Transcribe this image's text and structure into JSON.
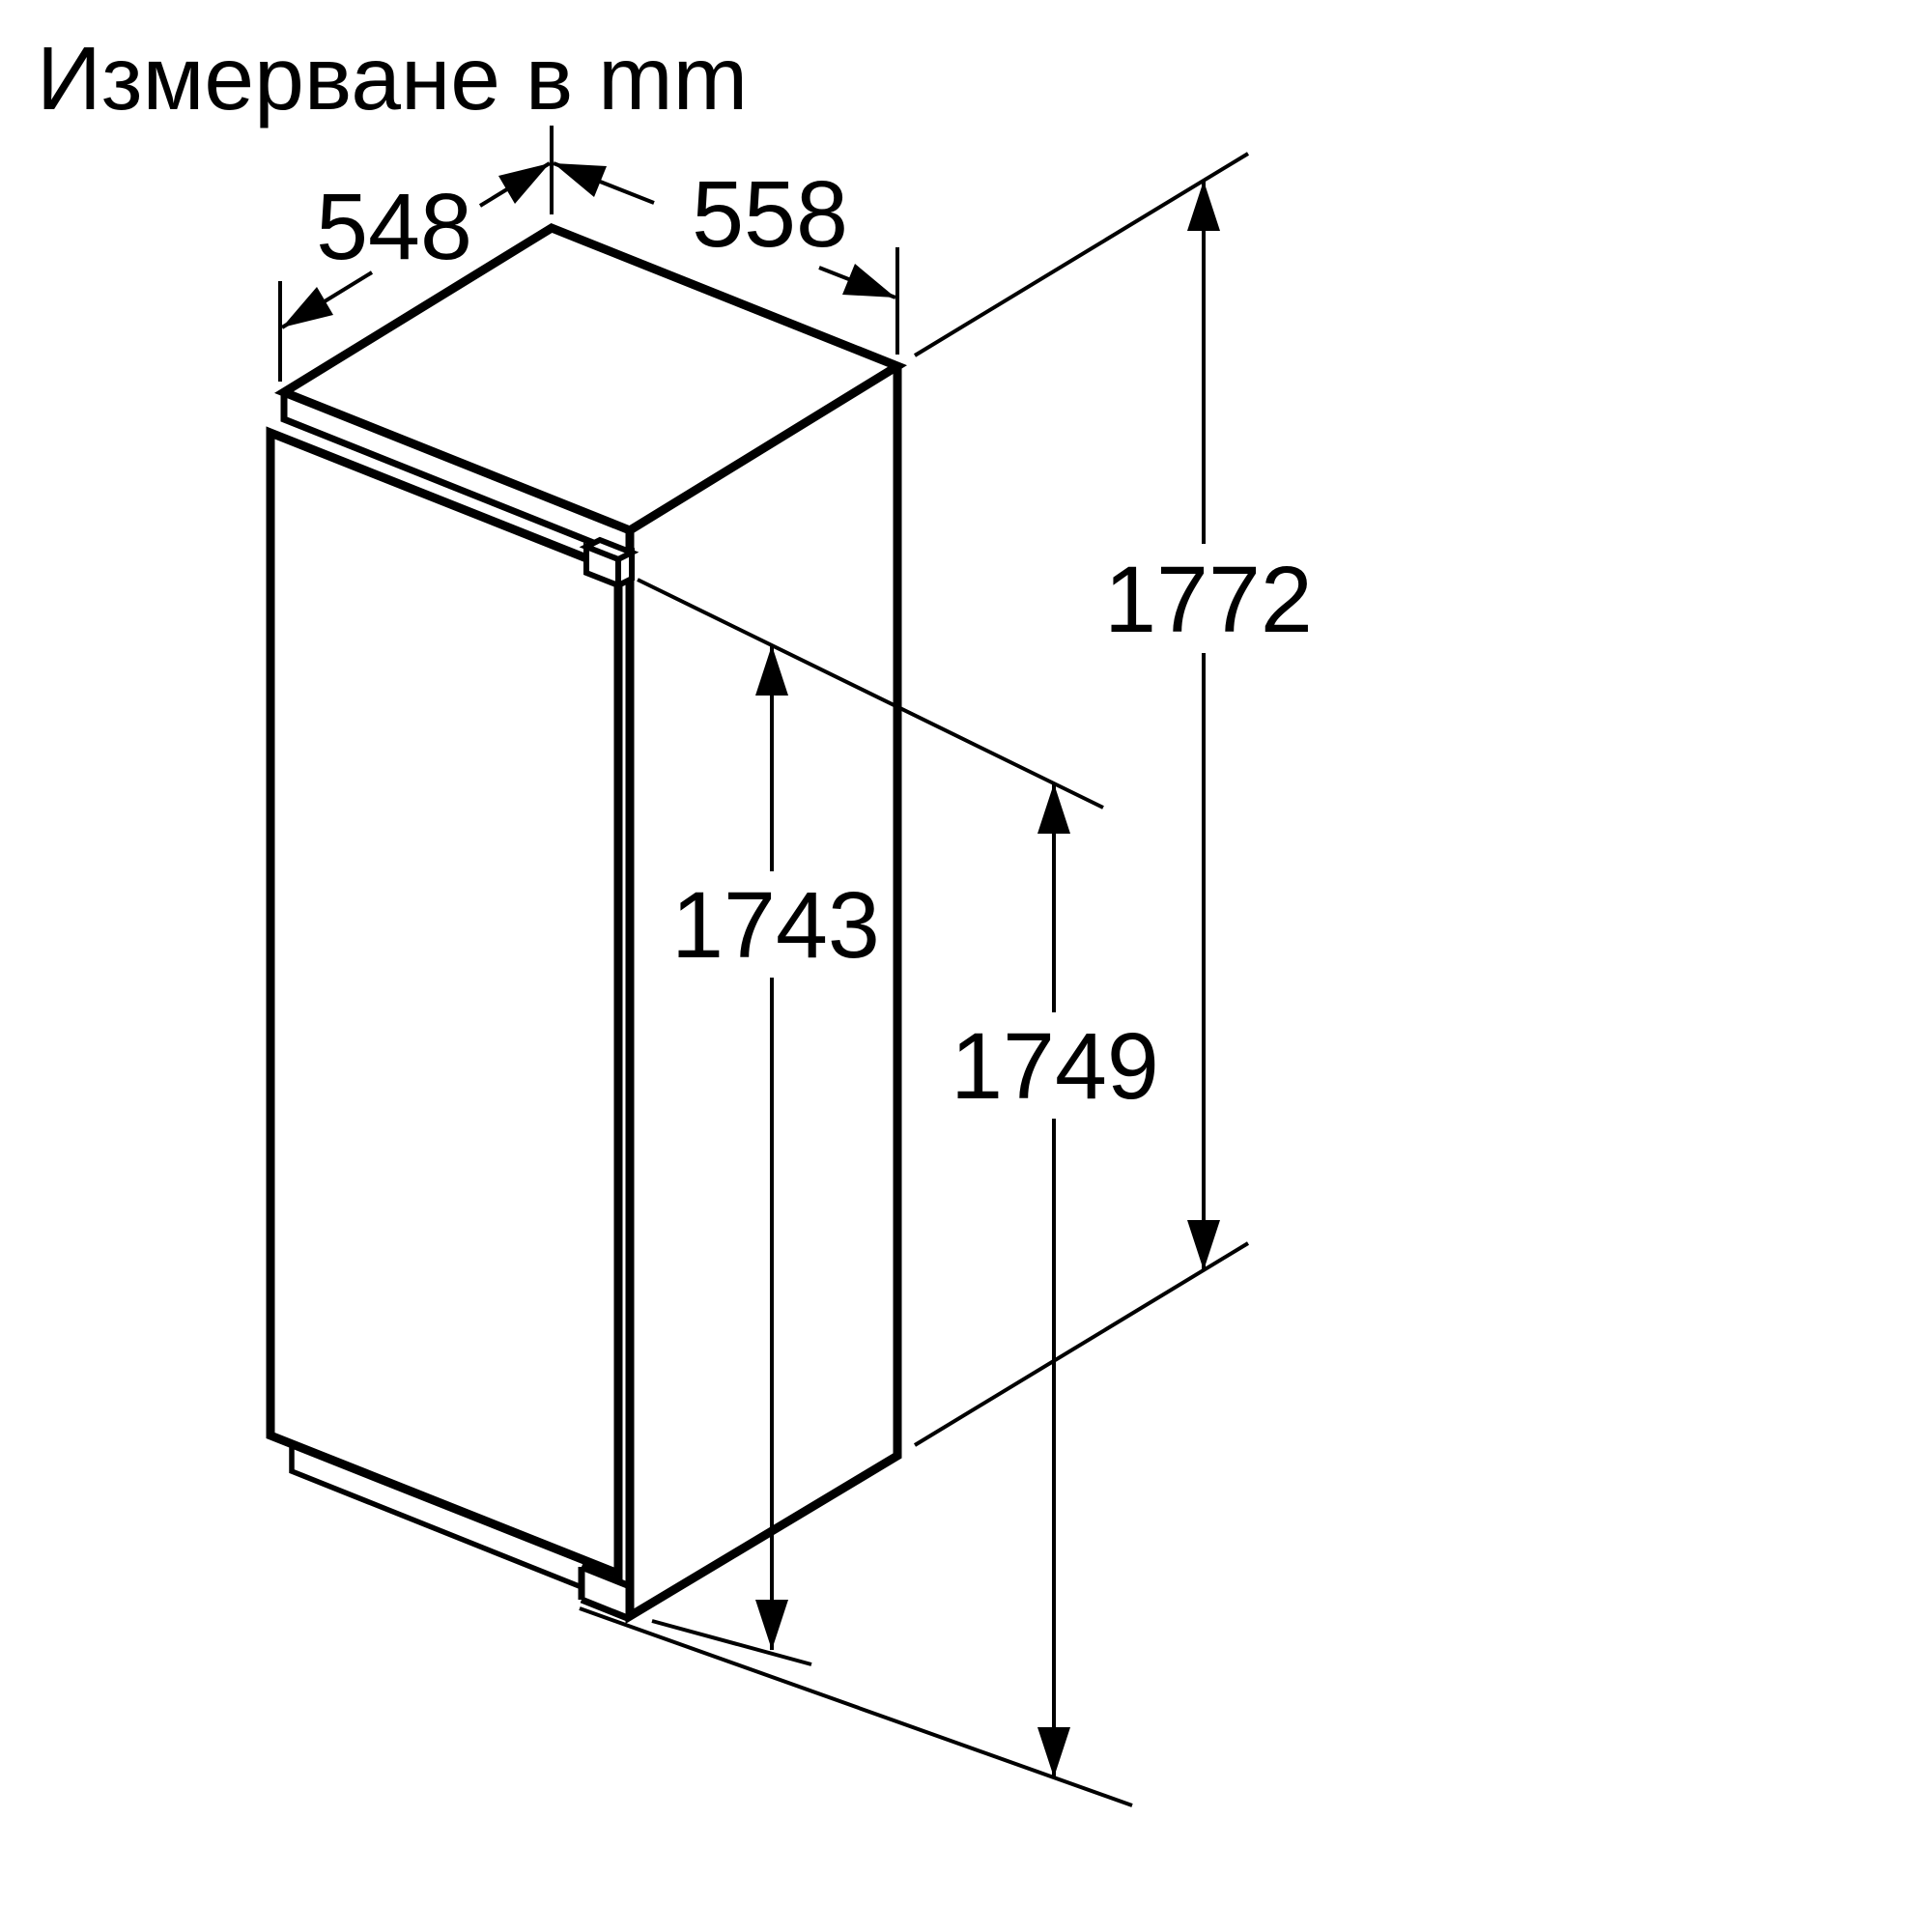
{
  "title": "Измерване в mm",
  "dimensions": {
    "top_left": "548",
    "top_right": "558",
    "right": "1772",
    "center": "1743",
    "bottom_right": "1749"
  },
  "colors": {
    "line": "#000000",
    "background": "#ffffff"
  }
}
